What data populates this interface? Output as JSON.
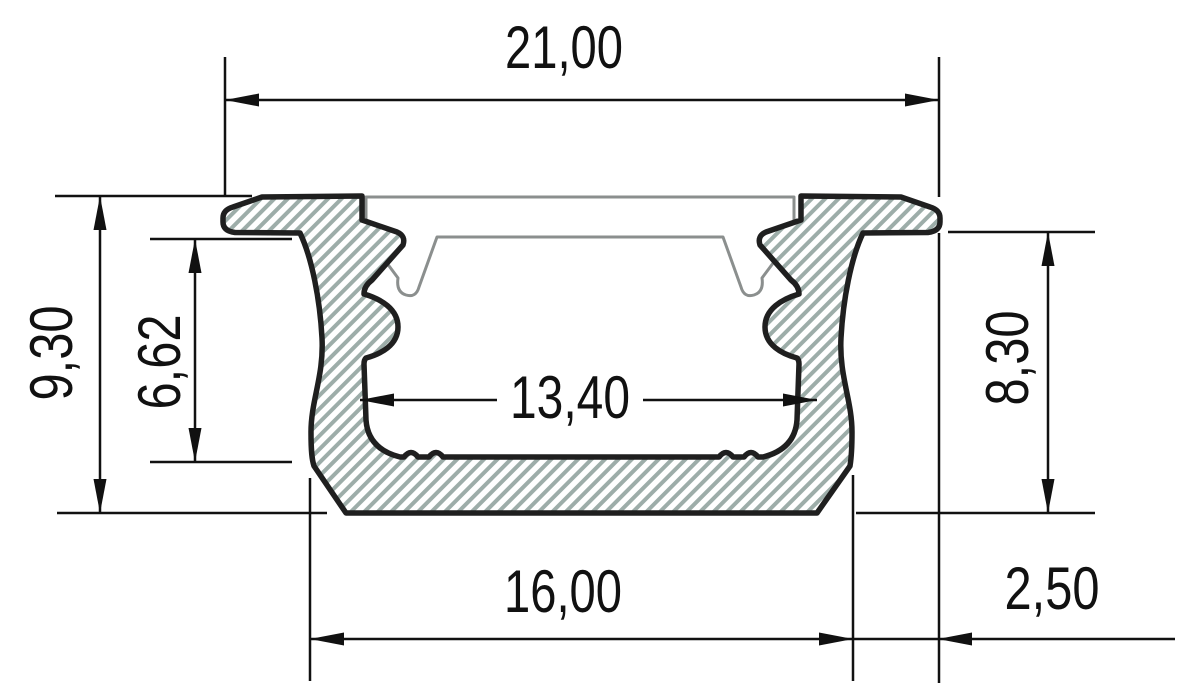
{
  "drawing": {
    "type": "technical-cross-section",
    "subject": "recessed aluminium LED profile with diffuser cover",
    "background": "#ffffff",
    "outline_color": "#1f1f1f",
    "hatch_color": "#9dada9",
    "cover_color": "#8b8f8e",
    "dimension_color": "#111111",
    "dimensions": {
      "top_width": "21,00",
      "left_height": "9,30",
      "inner_height": "6,62",
      "inner_width": "13,40",
      "right_height": "8,30",
      "bottom_width": "16,00",
      "flange_width": "2,50"
    }
  }
}
